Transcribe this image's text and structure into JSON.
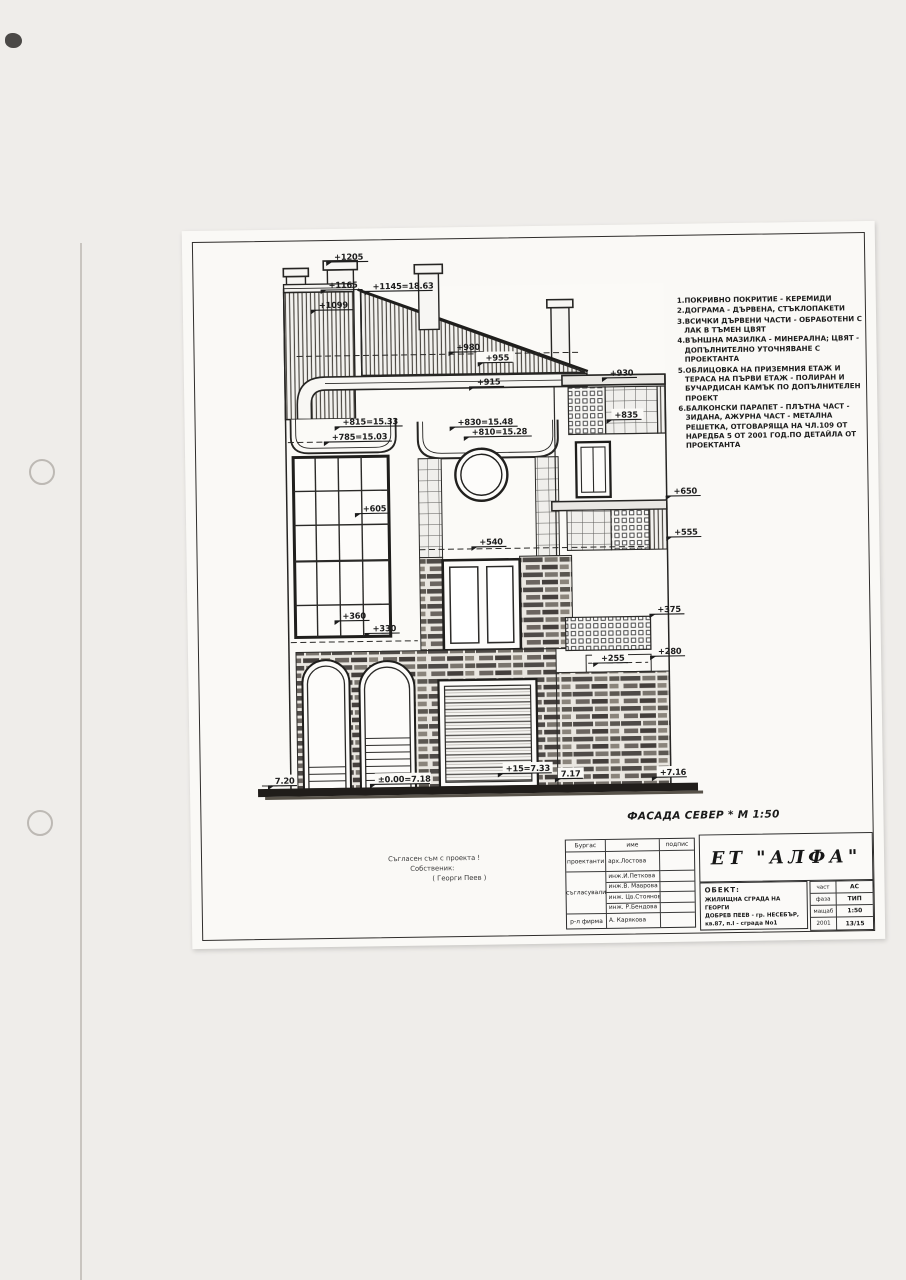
{
  "notes": [
    "1.ПОКРИВНО ПОКРИТИЕ - КЕРЕМИДИ",
    "2.ДОГРАМА - ДЪРВЕНА, СТЪКЛОПАКЕТИ",
    "3.ВСИЧКИ ДЪРВЕНИ ЧАСТИ - ОБРАБОТЕНИ С ЛАК В ТЪМЕН ЦВЯТ",
    "4.ВЪНШНА МАЗИЛКА - МИНЕРАЛНА; ЦВЯТ - ДОПЪЛНИТЕЛНО УТОЧНЯВАНЕ С ПРОЕКТАНТА",
    "5.ОБЛИЦОВКА НА ПРИЗЕМНИЯ ЕТАЖ И ТЕРАСА НА ПЪРВИ ЕТАЖ - ПОЛИРАН И БУЧАРДИСАН КАМЪК ПО ДОПЪЛНИТЕЛЕН ПРОЕКТ",
    "6.БАЛКОНСКИ ПАРАПЕТ - ПЛЪТНА ЧАСТ - ЗИДАНА, АЖУРНА ЧАСТ - МЕТАЛНА РЕШЕТКА, ОТГОВАРЯЩА НА ЧЛ.109 ОТ НАРЕДБА 5 ОТ 2001 ГОД.ПО ДЕТАЙЛА ОТ ПРОЕКТАНТА"
  ],
  "facade_title": "ФАСАДА СЕВЕР * М 1:50",
  "drawing": {
    "elevations": [
      "+1205",
      "+1165",
      "+1145=18.63",
      "+1099",
      "+980",
      "+955",
      "+915",
      "+930",
      "+835",
      "+815=15.33",
      "+785=15.03",
      "+830=15.48",
      "+810=15.28",
      "+605",
      "+540",
      "+650",
      "+555",
      "+360",
      "+330",
      "+375",
      "+280",
      "+255",
      "7.20",
      "±0.00=7.18",
      "+15=7.33",
      "7.17",
      "+7.16"
    ]
  },
  "owner_block": {
    "line1": "Съгласен съм с проекта !",
    "line2": "Собственик:",
    "line3": "( Георги Пеев )"
  },
  "title_block": {
    "city": "Бургас",
    "col_name": "име",
    "col_sign": "подпис",
    "role_designer": "проектанти",
    "role_agreed": "съгласували",
    "role_manager": "р-л фирма",
    "names": [
      "арх.Лостова",
      "инж.И.Петкова",
      "инж.В. Маврова",
      "инж. Цв.Стоянова",
      "инж. Р.Бендова",
      "А. Карякова"
    ],
    "company": "ЕТ \"АЛФА\"",
    "object_label": "ОБЕКТ:",
    "object_lines": [
      "ЖИЛИЩНА СГРАДА НА ГЕОРГИ",
      "ДОБРЕВ ПЕЕВ - гр. НЕСЕБЪР,",
      "кв.87, п.I - сграда No1"
    ],
    "meta": [
      {
        "label": "част",
        "value": "АС"
      },
      {
        "label": "фаза",
        "value": "ТИП"
      },
      {
        "label": "мащаб",
        "value": "1:50"
      },
      {
        "label": "2001",
        "value": "13/15"
      }
    ]
  }
}
